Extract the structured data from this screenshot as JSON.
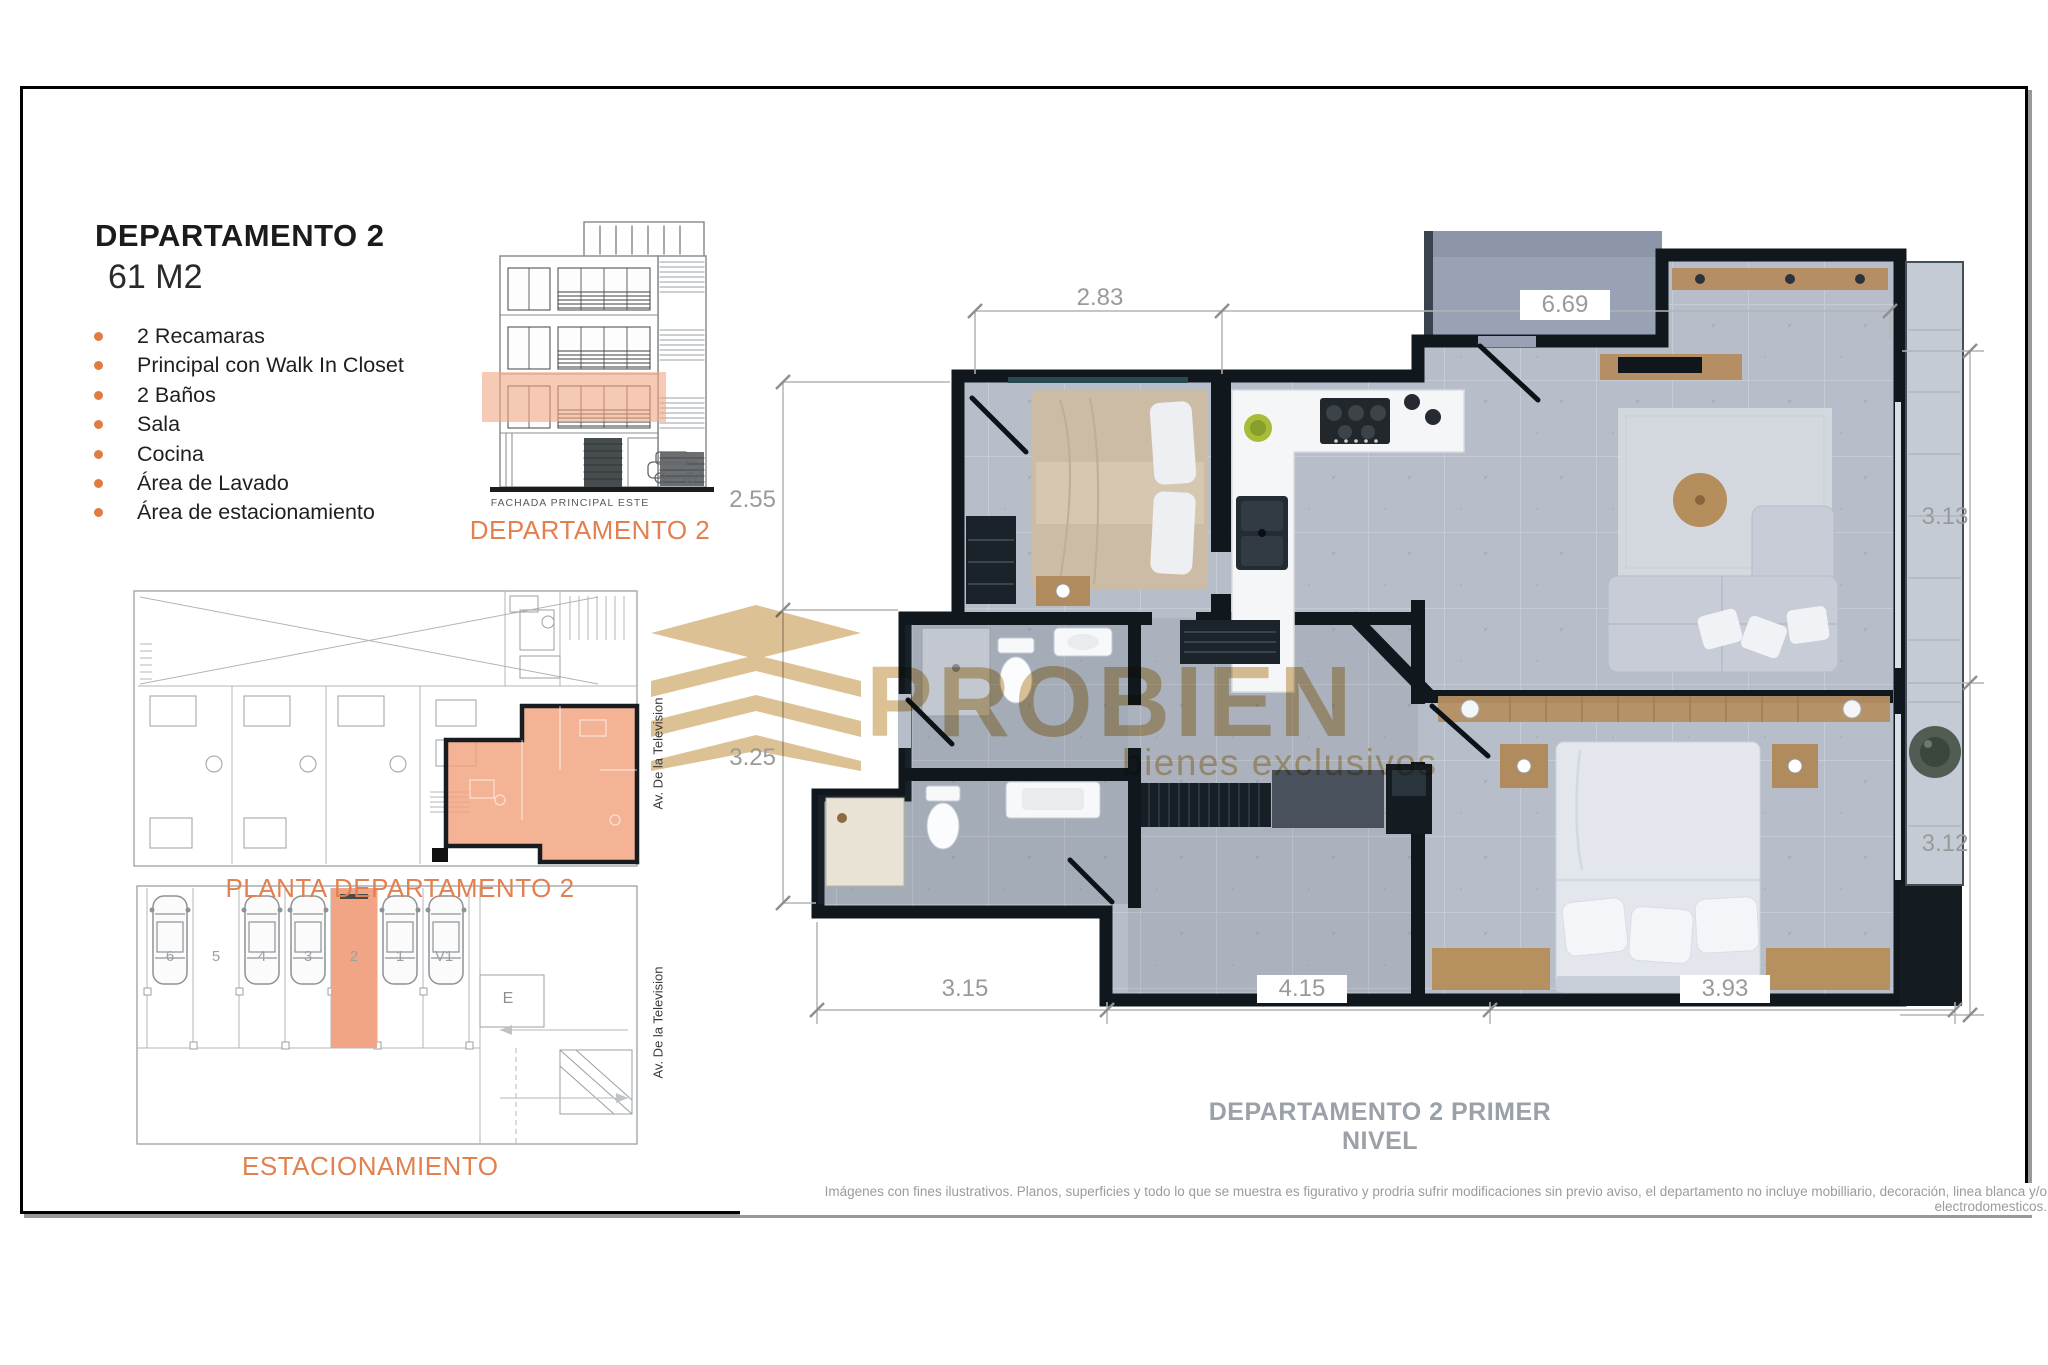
{
  "header": {
    "title": "DEPARTAMENTO 2",
    "area": "61 M2"
  },
  "features": [
    "2 Recamaras",
    "Principal con Walk In Closet",
    "2  Baños",
    "Sala",
    "Cocina",
    "Área de Lavado",
    "Área de estacionamiento"
  ],
  "facade": {
    "label": "FACHADA PRINCIPAL ESTE",
    "caption": "DEPARTAMENTO 2"
  },
  "planta": {
    "caption": "PLANTA DEPARTAMENTO 2"
  },
  "parking": {
    "caption": "ESTACIONAMIENTO",
    "stalls": [
      "6",
      "5",
      "4",
      "3",
      "2",
      "1",
      "V1"
    ],
    "elevator_label": "E",
    "highlighted_stall": "2"
  },
  "street_label": "Av. De la Television",
  "main_plan": {
    "caption": "DEPARTAMENTO 2 PRIMER NIVEL",
    "dimensions": {
      "top": [
        "2.83",
        "6.69"
      ],
      "left": [
        "2.55",
        "3.25"
      ],
      "right": [
        "3.13",
        "3.12"
      ],
      "bottom": [
        "3.15",
        "4.15",
        "3.93"
      ]
    }
  },
  "watermark": {
    "brand": "PROBIEN",
    "tagline": "bienes exclusivos"
  },
  "disclaimer": "Imágenes con fines ilustrativos. Planos, superficies y todo lo que se muestra es figurativo y prodria sufrir modificaciones sin previo aviso, el departamento no incluye mobilliario, decoración, linea blanca y/o electrodomesticos.",
  "colors": {
    "accent": "#E2814F",
    "highlight": "#F2A584",
    "wall": "#10181D",
    "floor": "#B7BEC9",
    "terrace": "#98A2B4",
    "wood": "#B58F63",
    "watermark_tan": "#DCC194",
    "dim_text": "#9A9A9A"
  }
}
